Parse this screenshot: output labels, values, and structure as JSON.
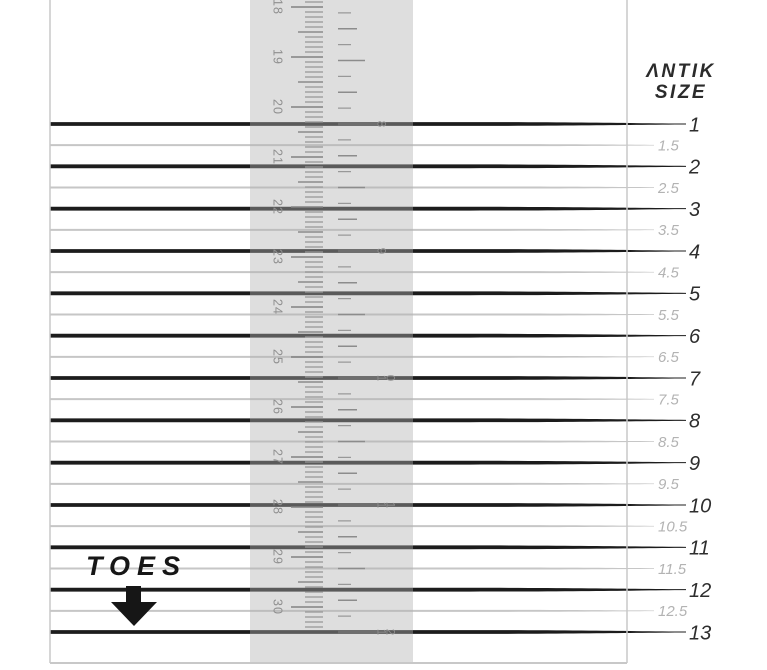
{
  "brand": {
    "line1": "ANTIK",
    "line2": "SIZE"
  },
  "toes_label": "TOES",
  "size_scale": {
    "full_sizes": [
      "1",
      "2",
      "3",
      "4",
      "5",
      "6",
      "7",
      "8",
      "9",
      "10",
      "11",
      "12",
      "13"
    ],
    "half_sizes": [
      "1.5",
      "2.5",
      "3.5",
      "4.5",
      "5.5",
      "6.5",
      "7.5",
      "8.5",
      "9.5",
      "10.5",
      "11.5",
      "12.5"
    ]
  },
  "ruler": {
    "cm_labels": [
      "18",
      "19",
      "20",
      "21",
      "22",
      "23",
      "24",
      "25",
      "26",
      "27",
      "28",
      "29",
      "30"
    ],
    "inch_labels": [
      "8",
      "9",
      "10",
      "11",
      "12"
    ]
  },
  "colors": {
    "full_line": "#1c1c1c",
    "half_line": "#c6c6c6",
    "border": "#c8c8c8",
    "strip": "rgba(177,177,177,0.42)",
    "tick_minor": "#969696",
    "tick_mid": "#8c8c8c",
    "tick_cm_major": "#828282",
    "tick_inch_major": "#6e6e6e",
    "ruler_label": "#8f8f8f",
    "full_label": "#2e2e2e",
    "half_label": "#b3b3b3",
    "brand_text": "#2b2b2b",
    "toes_text": "#161616"
  }
}
